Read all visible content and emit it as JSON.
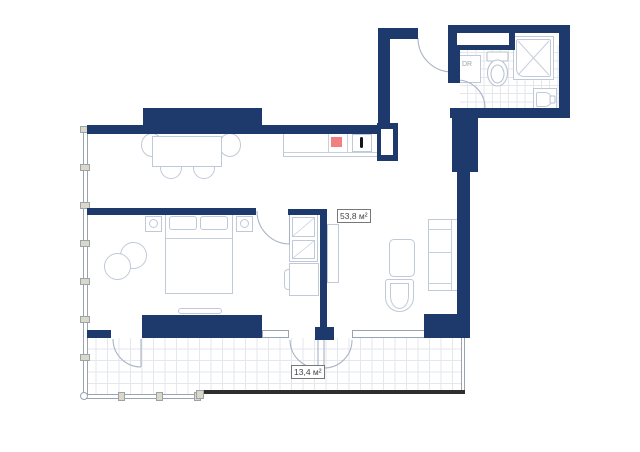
{
  "plan": {
    "labels": {
      "main_area": "53,8 м²",
      "balcony_area": "13,4 м²",
      "dryer": "DR"
    },
    "colors": {
      "wall": "#1e3a6d",
      "furniture_stroke": "#bfc9d8",
      "stove_accent": "#f28080",
      "tile_line": "#e4e7ec",
      "facade_line": "#9aa3b0",
      "railing": "#2e2e2e",
      "label_text": "#444444"
    }
  }
}
